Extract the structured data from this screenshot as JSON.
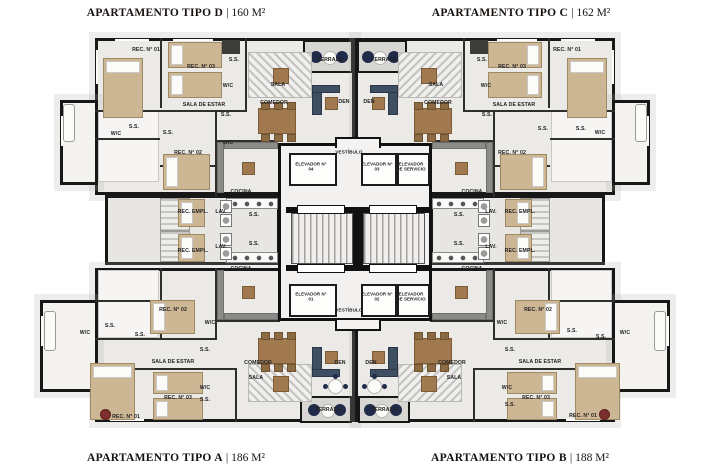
{
  "titles": {
    "separator": "|",
    "top_left": {
      "name": "APARTAMENTO TIPO D",
      "area": "160 M²"
    },
    "top_right": {
      "name": "APARTAMENTO TIPO C",
      "area": "162 M²"
    },
    "bottom_left": {
      "name": "APARTAMENTO TIPO A",
      "area": "186 M²"
    },
    "bottom_right": {
      "name": "APARTAMENTO TIPO B",
      "area": "188 M²"
    }
  },
  "colors": {
    "wall": "#171717",
    "floor": "#eceae7",
    "bed": "#cdb694",
    "wood": "#a07a4e",
    "navy": "#1f2b49",
    "den_sofa": "#3f4f63",
    "terrace_floor": "#d7d6d3",
    "plant_accent": "#7c2f2c",
    "label_text": "#222222"
  },
  "plan": {
    "labels": [
      {
        "t": "REC. N° 01",
        "x": 146,
        "y": 50
      },
      {
        "t": "S.S.",
        "x": 234,
        "y": 60
      },
      {
        "t": "REC. N° 03",
        "x": 201,
        "y": 67
      },
      {
        "t": "W/C",
        "x": 228,
        "y": 86
      },
      {
        "t": "SALA DE ESTAR",
        "x": 204,
        "y": 105
      },
      {
        "t": "S.S.",
        "x": 226,
        "y": 115
      },
      {
        "t": "S.S.",
        "x": 134,
        "y": 127
      },
      {
        "t": "W/C",
        "x": 116,
        "y": 134
      },
      {
        "t": "S.S.",
        "x": 168,
        "y": 133
      },
      {
        "t": "W/C",
        "x": 228,
        "y": 143
      },
      {
        "t": "REC. N° 02",
        "x": 188,
        "y": 153
      },
      {
        "t": "TERRAZA",
        "x": 330,
        "y": 60
      },
      {
        "t": "SALA",
        "x": 278,
        "y": 85
      },
      {
        "t": "COMEDOR",
        "x": 274,
        "y": 103
      },
      {
        "t": "DEN",
        "x": 344,
        "y": 102
      },
      {
        "t": "COCINA",
        "x": 241,
        "y": 192
      },
      {
        "t": "REC. EMPL.",
        "x": 193,
        "y": 212
      },
      {
        "t": "LAV.",
        "x": 221,
        "y": 212
      },
      {
        "t": "S.S.",
        "x": 254,
        "y": 215
      },
      {
        "t": "REC. EMPL.",
        "x": 193,
        "y": 251
      },
      {
        "t": "LAV.",
        "x": 221,
        "y": 247
      },
      {
        "t": "S.S.",
        "x": 254,
        "y": 244
      },
      {
        "t": "COCINA",
        "x": 241,
        "y": 269
      },
      {
        "t": "TERRAZA",
        "x": 384,
        "y": 60
      },
      {
        "t": "SALA",
        "x": 436,
        "y": 85
      },
      {
        "t": "COMEDOR",
        "x": 438,
        "y": 103
      },
      {
        "t": "DEN",
        "x": 369,
        "y": 102
      },
      {
        "t": "REC. N° 01",
        "x": 567,
        "y": 50
      },
      {
        "t": "S.S.",
        "x": 482,
        "y": 60
      },
      {
        "t": "REC. N° 03",
        "x": 512,
        "y": 67
      },
      {
        "t": "W/C",
        "x": 486,
        "y": 86
      },
      {
        "t": "SALA DE ESTAR",
        "x": 514,
        "y": 105
      },
      {
        "t": "S.S.",
        "x": 487,
        "y": 115
      },
      {
        "t": "S.S.",
        "x": 543,
        "y": 129
      },
      {
        "t": "S.S.",
        "x": 581,
        "y": 129
      },
      {
        "t": "W/C",
        "x": 600,
        "y": 133
      },
      {
        "t": "REC. N° 02",
        "x": 512,
        "y": 153
      },
      {
        "t": "COCINA",
        "x": 472,
        "y": 192
      },
      {
        "t": "S.S.",
        "x": 459,
        "y": 215
      },
      {
        "t": "LAV.",
        "x": 491,
        "y": 212
      },
      {
        "t": "REC. EMPL.",
        "x": 520,
        "y": 212
      },
      {
        "t": "S.S.",
        "x": 459,
        "y": 244
      },
      {
        "t": "LAV.",
        "x": 491,
        "y": 247
      },
      {
        "t": "REC. EMPL.",
        "x": 520,
        "y": 251
      },
      {
        "t": "COCINA",
        "x": 472,
        "y": 269
      },
      {
        "t": "VESTÍBULO",
        "x": 349,
        "y": 152,
        "s": 4.6
      },
      {
        "t": "ELEVADOR N° 04",
        "x": 311,
        "y": 167,
        "w": 34,
        "s": 4.4
      },
      {
        "t": "ELEVADOR N° 03",
        "x": 377,
        "y": 167,
        "w": 34,
        "s": 4.4
      },
      {
        "t": "ELEVADOR DE SERVICIO",
        "x": 411,
        "y": 167,
        "w": 32,
        "s": 4.4
      },
      {
        "t": "ELEVADOR N° 01",
        "x": 311,
        "y": 297,
        "w": 34,
        "s": 4.4
      },
      {
        "t": "ELEVADOR N° 02",
        "x": 377,
        "y": 297,
        "w": 34,
        "s": 4.4
      },
      {
        "t": "ELEVADOR DE SERVICIO",
        "x": 411,
        "y": 297,
        "w": 32,
        "s": 4.4
      },
      {
        "t": "VESTÍBULO",
        "x": 349,
        "y": 310,
        "s": 4.6
      },
      {
        "t": "REC. N° 02",
        "x": 173,
        "y": 310
      },
      {
        "t": "W/C",
        "x": 210,
        "y": 323
      },
      {
        "t": "S.S.",
        "x": 110,
        "y": 326
      },
      {
        "t": "W/C",
        "x": 85,
        "y": 333
      },
      {
        "t": "S.S.",
        "x": 140,
        "y": 335
      },
      {
        "t": "S.S.",
        "x": 205,
        "y": 350
      },
      {
        "t": "SALA DE ESTAR",
        "x": 173,
        "y": 362
      },
      {
        "t": "COMEDOR",
        "x": 258,
        "y": 363
      },
      {
        "t": "SALA",
        "x": 256,
        "y": 378
      },
      {
        "t": "DEN",
        "x": 340,
        "y": 363
      },
      {
        "t": "W/C",
        "x": 205,
        "y": 388
      },
      {
        "t": "REC. N° 03",
        "x": 178,
        "y": 398
      },
      {
        "t": "S.S.",
        "x": 205,
        "y": 400
      },
      {
        "t": "REC. N° 01",
        "x": 126,
        "y": 417
      },
      {
        "t": "TERRAZA",
        "x": 328,
        "y": 410
      },
      {
        "t": "TERRAZA",
        "x": 384,
        "y": 410
      },
      {
        "t": "DEN",
        "x": 371,
        "y": 363
      },
      {
        "t": "COMEDOR",
        "x": 452,
        "y": 363
      },
      {
        "t": "SALA",
        "x": 454,
        "y": 378
      },
      {
        "t": "REC. N° 02",
        "x": 538,
        "y": 310
      },
      {
        "t": "W/C",
        "x": 502,
        "y": 323
      },
      {
        "t": "S.S.",
        "x": 572,
        "y": 331
      },
      {
        "t": "S.S.",
        "x": 601,
        "y": 337
      },
      {
        "t": "W/C",
        "x": 625,
        "y": 333
      },
      {
        "t": "S.S.",
        "x": 510,
        "y": 350
      },
      {
        "t": "SALA DE ESTAR",
        "x": 540,
        "y": 362
      },
      {
        "t": "W/C",
        "x": 507,
        "y": 388
      },
      {
        "t": "REC. N° 03",
        "x": 536,
        "y": 398
      },
      {
        "t": "S.S.",
        "x": 510,
        "y": 405
      },
      {
        "t": "REC. N° 01",
        "x": 583,
        "y": 416
      }
    ]
  }
}
